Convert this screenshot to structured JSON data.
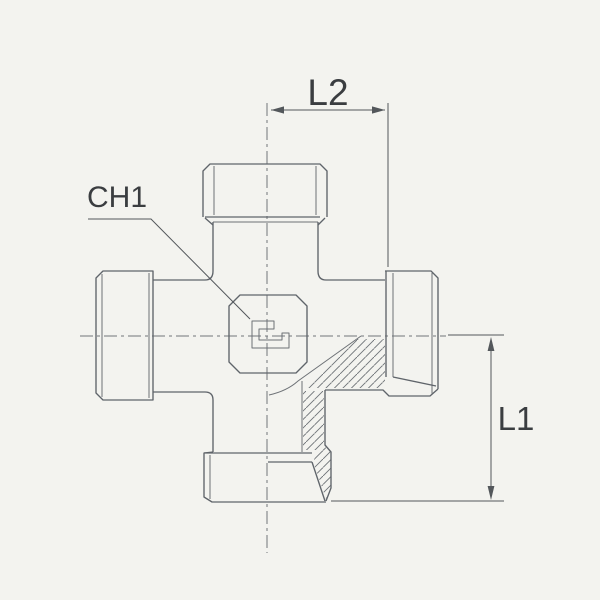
{
  "drawing": {
    "kind": "technical-drawing",
    "subject": "cross compression fitting, part section view",
    "labels": {
      "dim_top": "L2",
      "dim_right": "L1",
      "hex_label": "CH1"
    },
    "icons": {
      "center_mark": "squared-g-thread-mark"
    },
    "colors": {
      "background": "#f3f3ef",
      "line": "#5f646a",
      "thin_line": "#6d7176",
      "centerline": "#70747a",
      "dimension": "#53575b",
      "hatch": "#6d7176",
      "text": "#3a3d40"
    }
  }
}
